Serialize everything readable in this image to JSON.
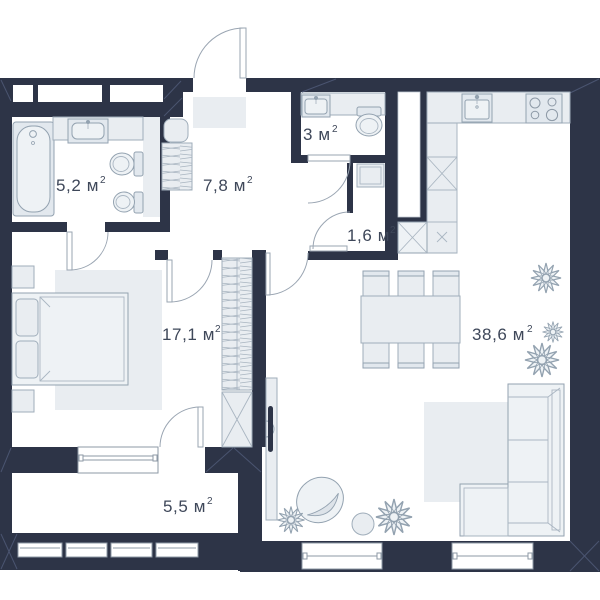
{
  "plan": {
    "rooms": [
      {
        "id": "bathroom",
        "label": "5,2 м",
        "sup": "2"
      },
      {
        "id": "hallway",
        "label": "7,8 м",
        "sup": "2"
      },
      {
        "id": "wc",
        "label": "3 м",
        "sup": "2"
      },
      {
        "id": "storage",
        "label": "1,6 м",
        "sup": "2"
      },
      {
        "id": "bedroom",
        "label": "17,1 м",
        "sup": "2"
      },
      {
        "id": "living-kitchen",
        "label": "38,6 м",
        "sup": "2"
      },
      {
        "id": "balcony",
        "label": "5,5 м",
        "sup": "2"
      }
    ],
    "colors": {
      "wall": "#2d3447",
      "furniture_fill": "#e9edf1",
      "furniture_stroke": "#9fadba",
      "door_arc": "#9aa5b2",
      "label_text": "#3e4759",
      "background": "#ffffff"
    }
  }
}
